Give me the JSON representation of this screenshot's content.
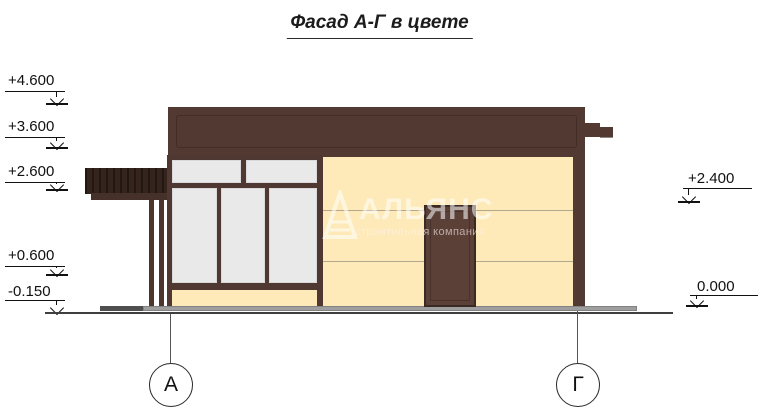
{
  "title": {
    "text": "Фасад А-Г в цвете"
  },
  "elevation_marks": {
    "left": [
      {
        "label": "+4.600"
      },
      {
        "label": "+3.600"
      },
      {
        "label": "+2.600"
      },
      {
        "label": "+0.600"
      },
      {
        "label": "-0.150"
      }
    ],
    "right": [
      {
        "label": "+2.400"
      },
      {
        "label": "0.000"
      }
    ]
  },
  "axes": [
    {
      "label": "А"
    },
    {
      "label": "Г"
    }
  ],
  "watermark": {
    "name": "АЛЬЯНС",
    "tagline": "строительная компания"
  },
  "colors": {
    "roof": "#523a32",
    "roof_line": "#432e27",
    "canopy": "#35241e",
    "canopy_rib": "#231712",
    "canopy_fascia": "#46302a",
    "frame": "#4f3831",
    "pane": "#e9e9ea",
    "wall": "#fdeab8",
    "door": "#5a4037",
    "door_border": "#3a2a24",
    "post": "#4c352d",
    "plinth": "#9e9e9e",
    "step": "#4f4f4f",
    "ground": "#3f3f3f"
  }
}
